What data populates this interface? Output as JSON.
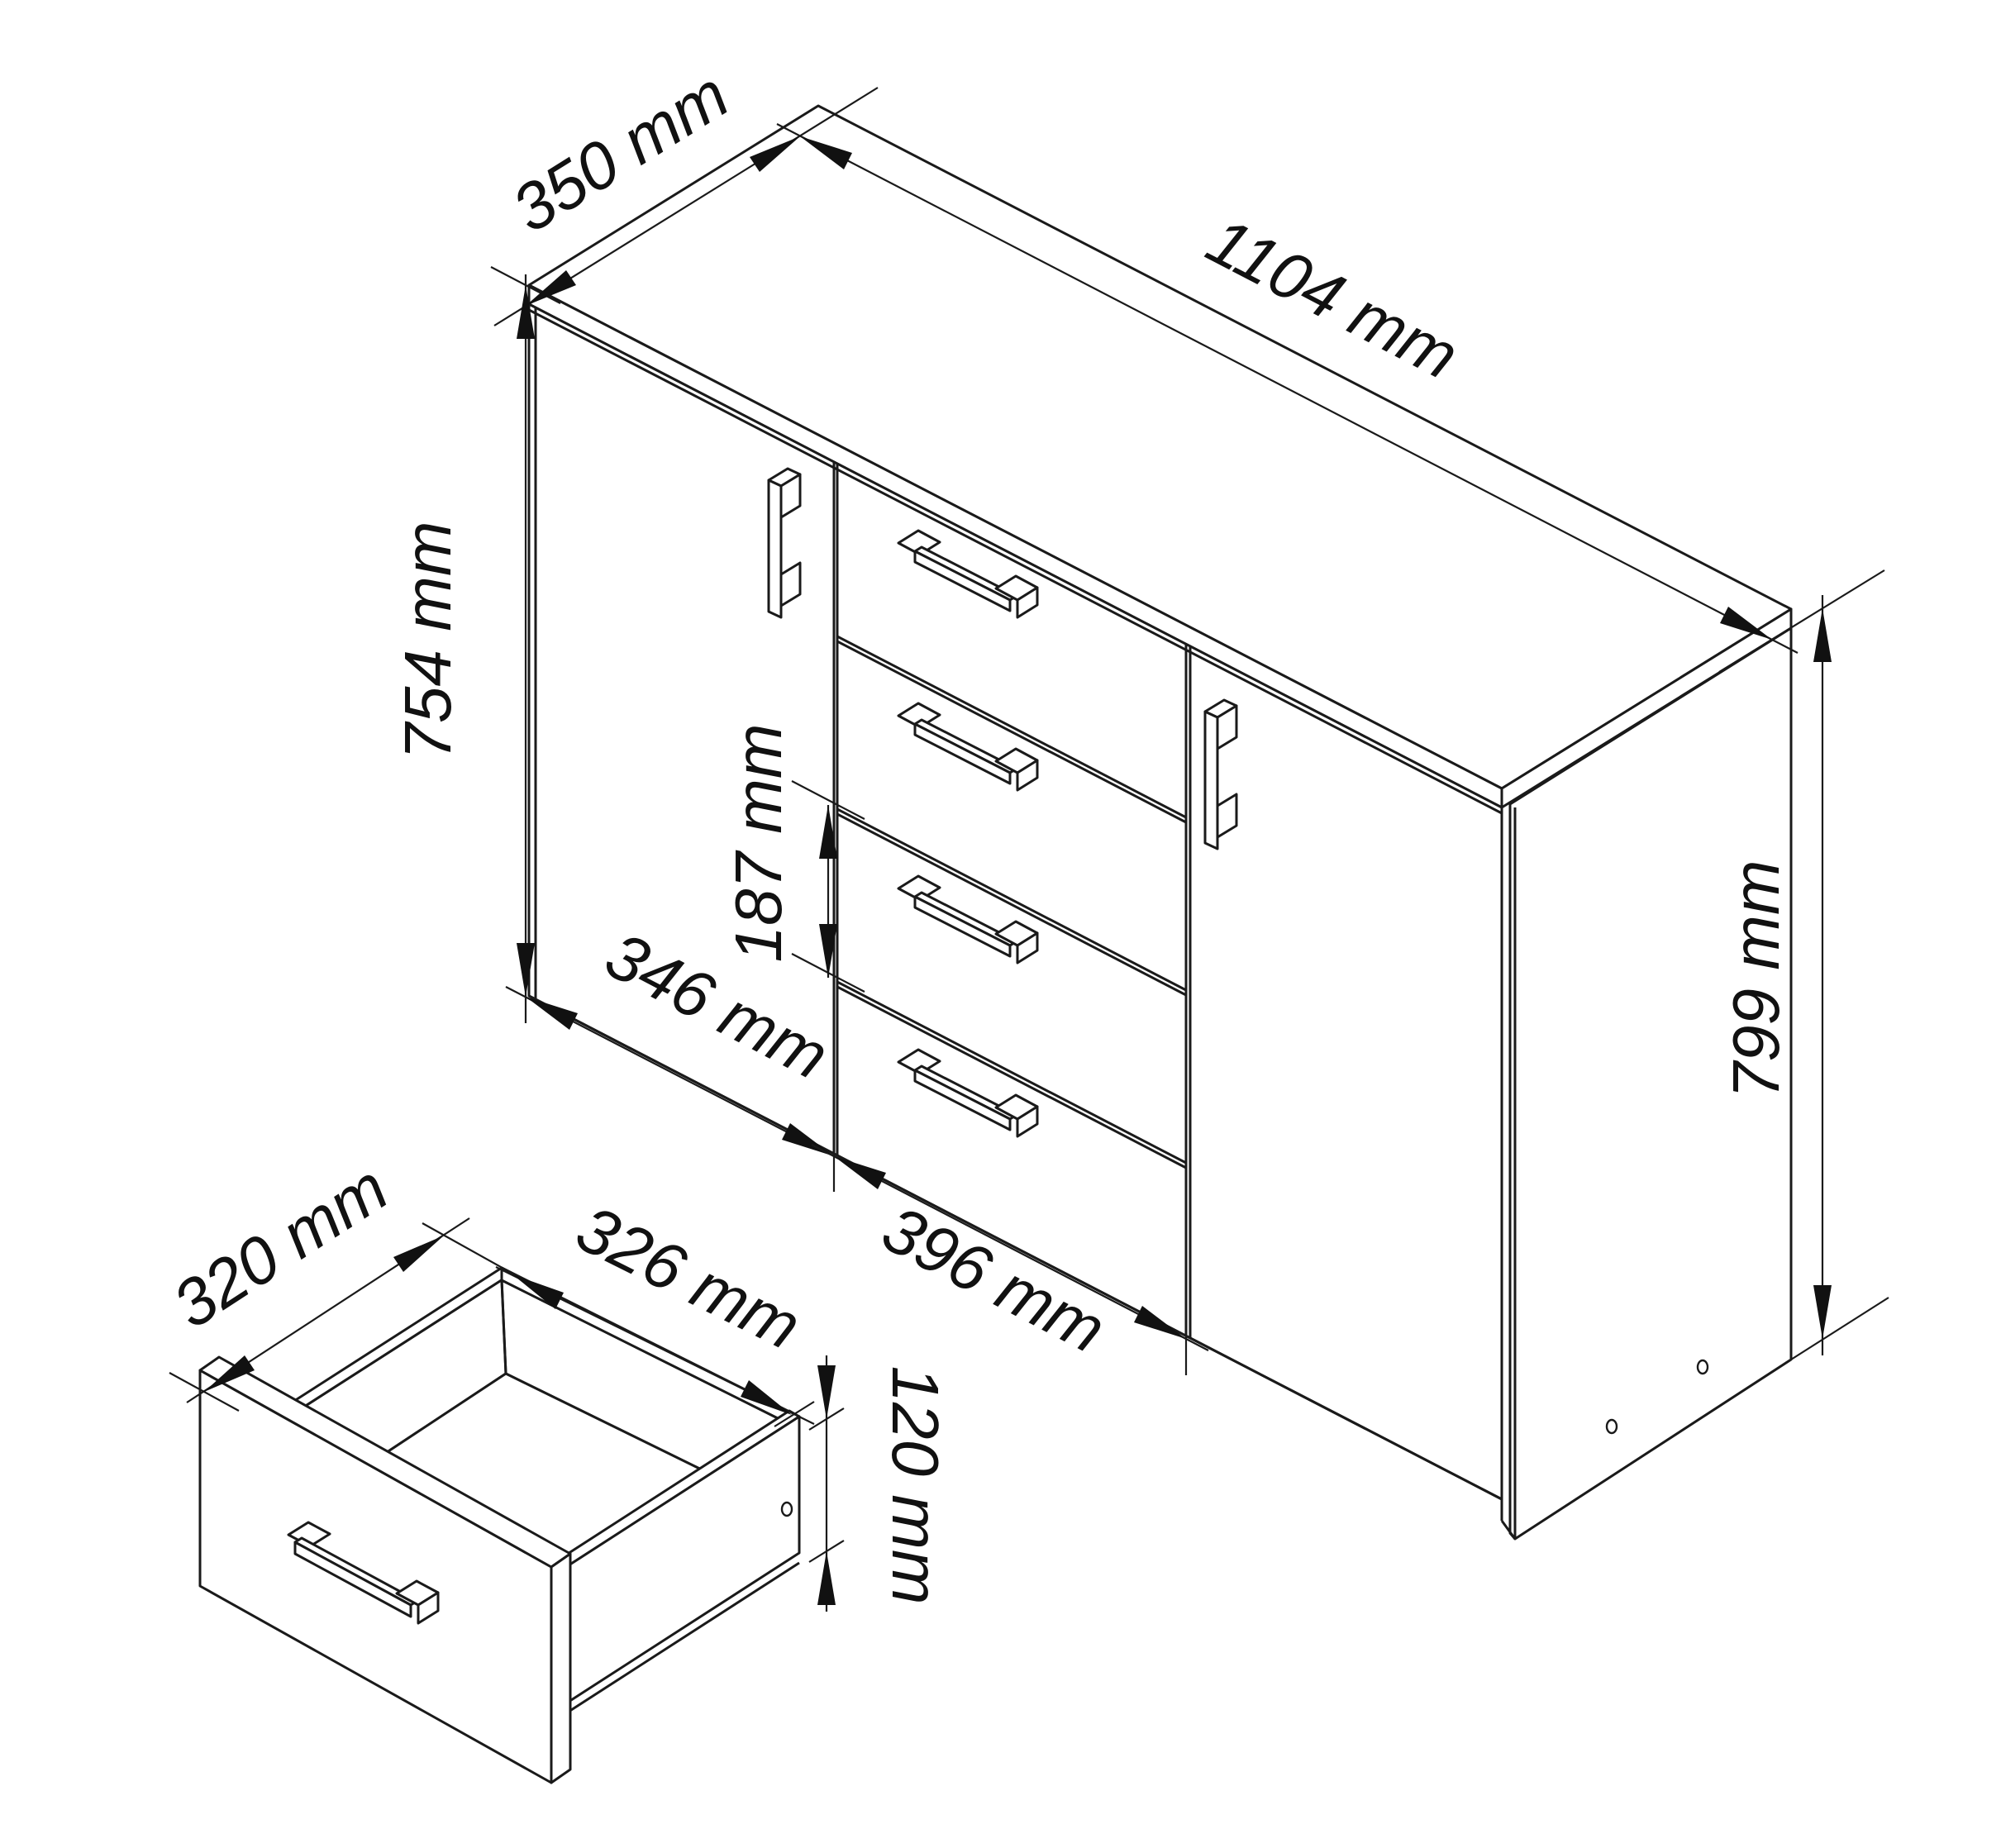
{
  "drawing": {
    "type": "technical-dimension-diagram",
    "subject": "sideboard cabinet with two doors and four central drawers, with separate open drawer-box detail",
    "unit": "mm",
    "line_color": "#1a1a1a",
    "background_color": "#ffffff",
    "cabinet": {
      "width_label": "1104 mm",
      "top_depth_label": "350 mm",
      "front_height_label": "754 mm",
      "total_height_label": "799 mm",
      "left_door_width_label": "346 mm",
      "drawer_section_width_label": "396 mm",
      "drawer_front_height_label": "187 mm",
      "doors": 2,
      "drawers": 4
    },
    "drawer_detail": {
      "depth_label": "320 mm",
      "inner_width_label": "326 mm",
      "side_height_label": "120 mm"
    }
  }
}
